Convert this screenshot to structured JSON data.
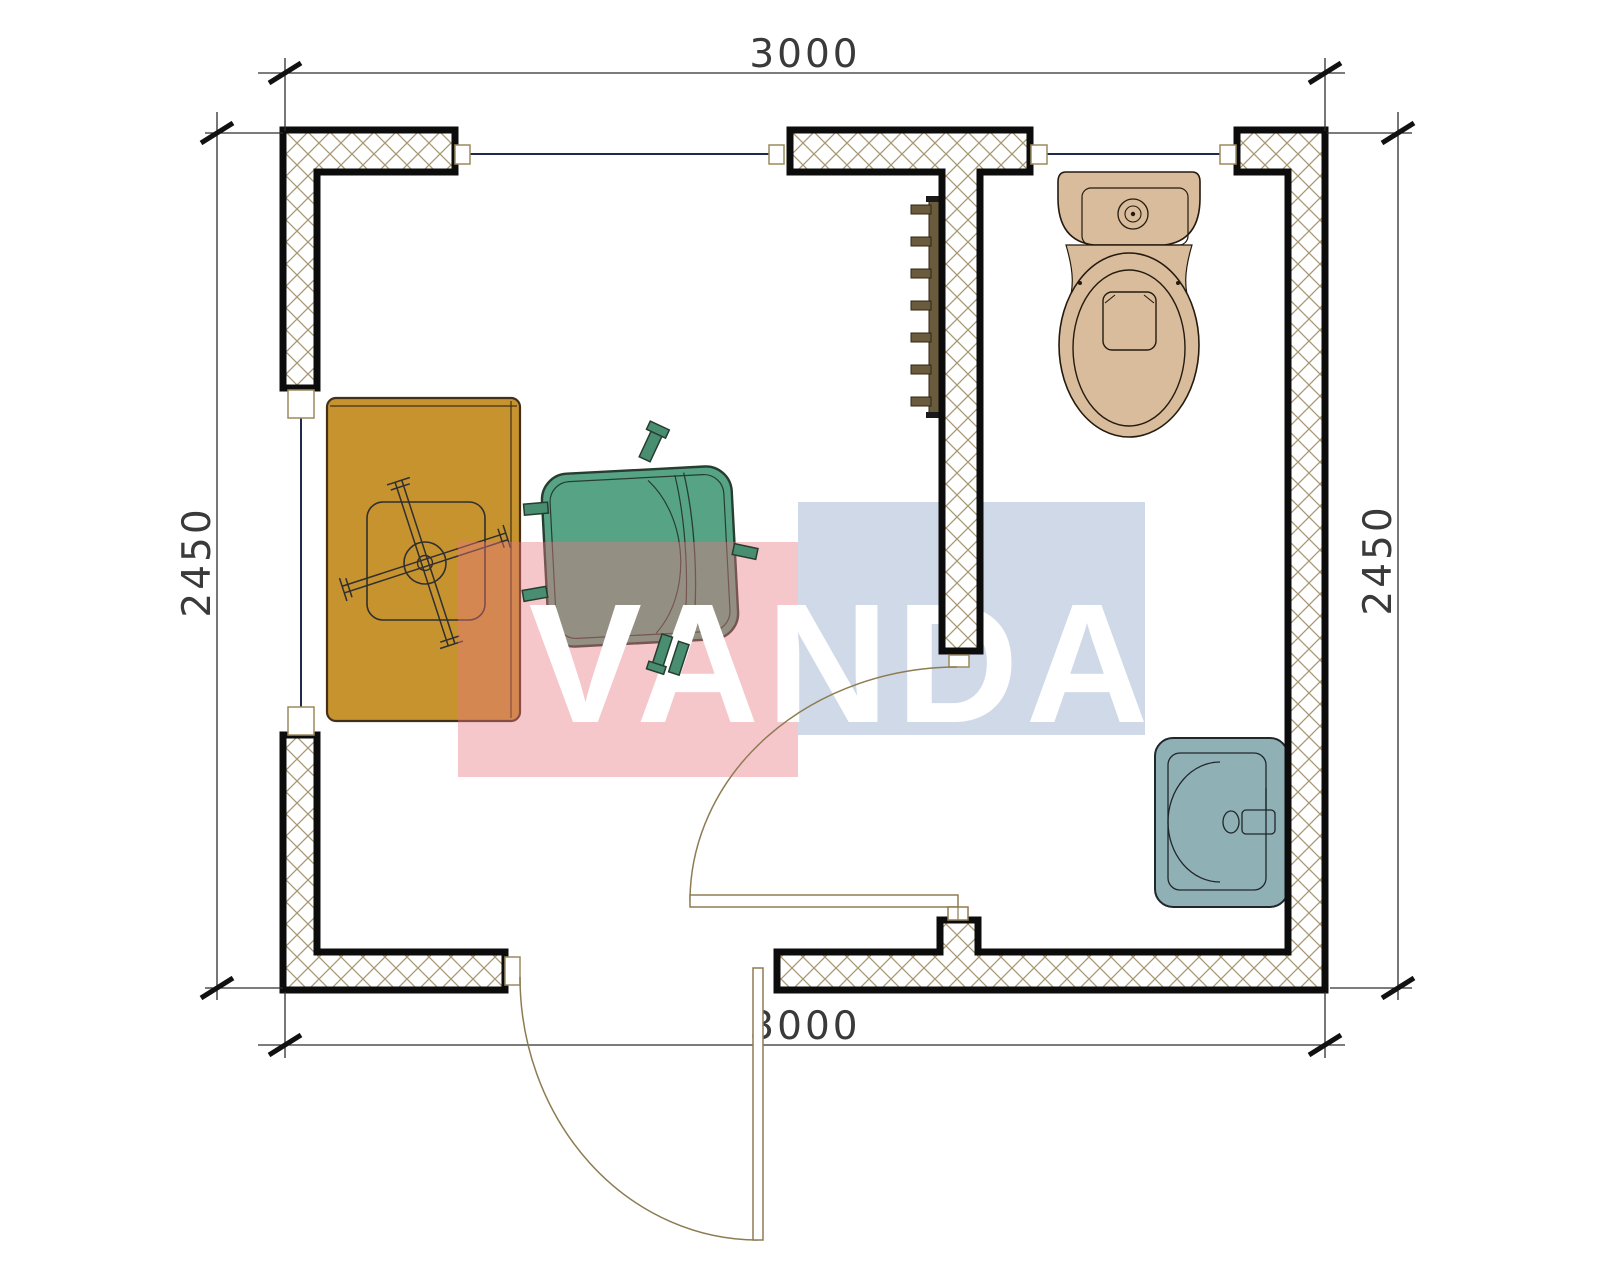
{
  "dimensions": {
    "top": "3000",
    "bottom": "3000",
    "left": "2450",
    "right": "2450"
  },
  "watermark": {
    "text": "VANDA",
    "pink": "#e87681",
    "blue": "#8ca4c8"
  },
  "colors": {
    "wall_hatch": "#a89873",
    "wall_edge": "#0c0c0c",
    "glazing": "#1f2a4d",
    "desk": "#c7932e",
    "desk_edge": "#42301a",
    "armchair": "#57a386",
    "armchair_leg": "#4a8e72",
    "armchair_edge": "#263d2f",
    "radiator": "#6a5b3c",
    "toilet": "#d9bc9c",
    "sink": "#8fb0b5",
    "sink_edge": "#20262a"
  }
}
